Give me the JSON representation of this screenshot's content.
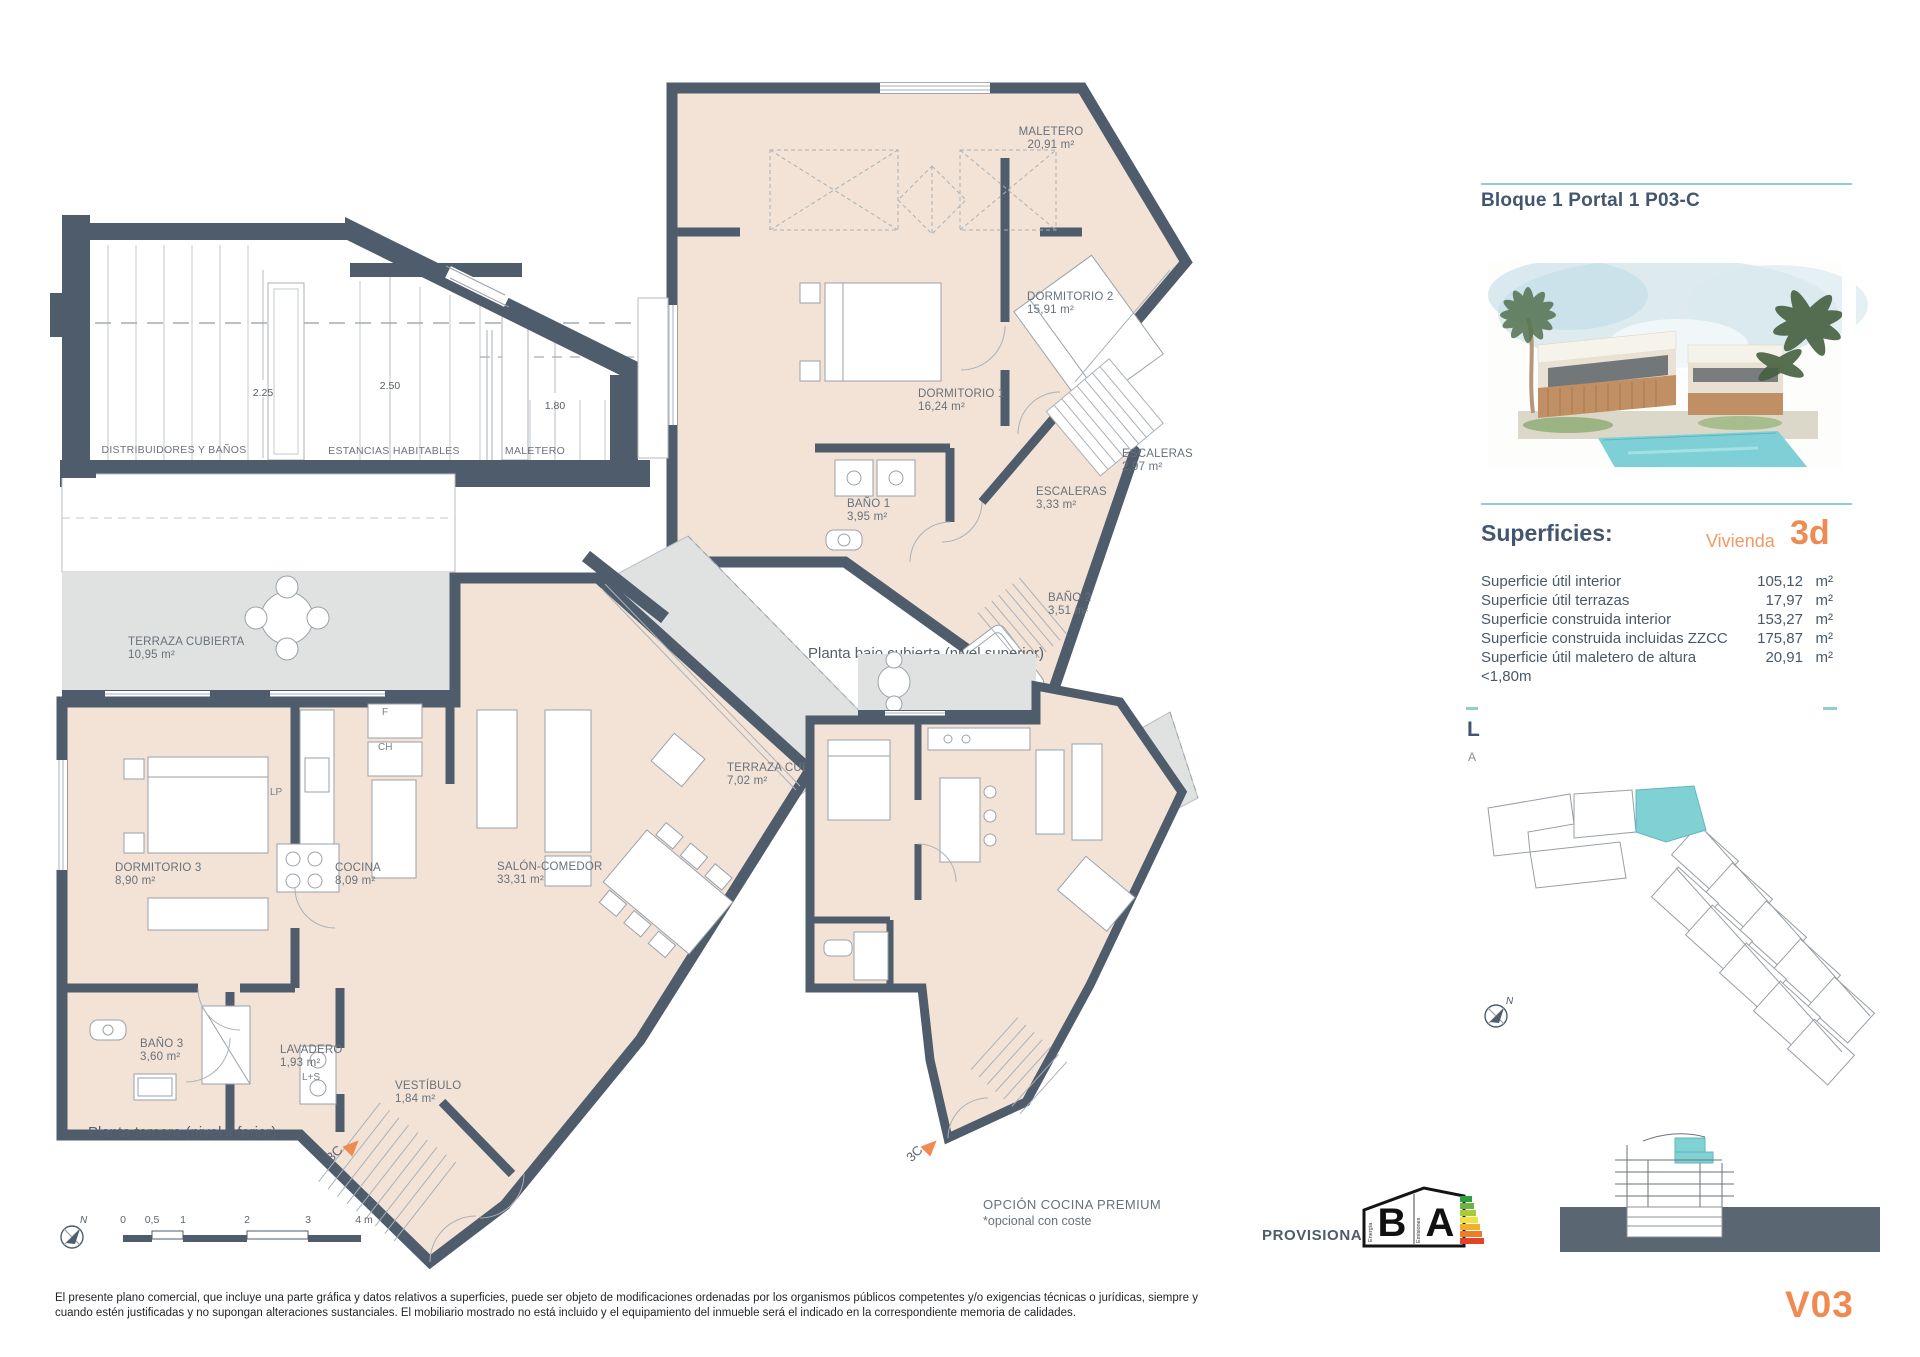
{
  "doc": {
    "version": "V03",
    "provisional": "PROVISIONAL",
    "disclaimer1": "El presente plano comercial, que incluye una parte gráfica y datos relativos a superficies, puede ser objeto de modificaciones ordenadas por los organismos públicos competentes y/o exigencias técnicas o jurídicas, siempre y",
    "disclaimer2": "cuando estén justificadas y no supongan alteraciones sustanciales. El mobiliario mostrado no está incluido y el equipamiento del inmueble será el indicado en la correspondiente memoria de calidades."
  },
  "colors": {
    "teal": "#8ed0d1",
    "orange": "#ef8a50",
    "slate": "#4e5c6b",
    "room_fill": "#f2e3d6",
    "terrace_fill": "#e0e2e1",
    "highlight": "#7fd1d4"
  },
  "section": {
    "caption": "Esquema de sección en planta ático",
    "dims": [
      "2.25",
      "2.50",
      "1.80"
    ],
    "zones": [
      "DISTRIBUIDORES Y BAÑOS",
      "ESTANCIAS HABITABLES",
      "MALETERO"
    ]
  },
  "upper_plan": {
    "caption": "Planta bajo cubierta (nivel superior)",
    "rooms": [
      {
        "name": "MALETERO",
        "area": "20,91 m²"
      },
      {
        "name": "DORMITORIO 2",
        "area": "15,91 m²"
      },
      {
        "name": "DORMITORIO 1",
        "area": "16,24 m²"
      },
      {
        "name": "BAÑO 1",
        "area": "3,95 m²"
      },
      {
        "name": "ESCALERAS",
        "area": "3,33 m²"
      },
      {
        "name": "ESCALERAS",
        "area": "2,97 m²"
      },
      {
        "name": "BAÑO 2",
        "area": "3,51 m²"
      }
    ]
  },
  "lower_plan": {
    "caption": "Planta tercera (nivel inferior)",
    "unit_marker": "3C",
    "rooms": [
      {
        "name": "TERRAZA CUBIERTA",
        "area": "10,95 m²"
      },
      {
        "name": "DORMITORIO 3",
        "area": "8,90 m²"
      },
      {
        "name": "COCINA",
        "area": "8,09 m²"
      },
      {
        "name": "SALÓN-COMEDOR",
        "area": "33,31 m²"
      },
      {
        "name": "TERRAZA CUBIERTA",
        "area": "7,02 m²"
      },
      {
        "name": "BAÑO 3",
        "area": "3,60 m²"
      },
      {
        "name": "LAVADERO",
        "area": "1,93 m²"
      },
      {
        "name": "VESTÍBULO",
        "area": "1,84 m²"
      }
    ],
    "appliances": {
      "f": "F",
      "ch": "CH",
      "lp": "LP",
      "ls": "L+S"
    }
  },
  "premium_plan": {
    "title": "OPCIÓN COCINA PREMIUM",
    "subtitle": "*opcional con coste",
    "unit_marker": "3C"
  },
  "right_panel": {
    "title": "Bloque 1 Portal 1 P03-C",
    "superficies_heading": "Superficies:",
    "vivienda_label": "Vivienda",
    "vivienda_code": "3d",
    "rows": [
      {
        "label": "Superficie útil interior",
        "value": "105,12",
        "unit": "m²"
      },
      {
        "label": "Superficie útil terrazas",
        "value": "17,97",
        "unit": "m²"
      },
      {
        "label": "Superficie construida interior",
        "value": "153,27",
        "unit": "m²"
      },
      {
        "label": "Superficie construida incluidas ZZCC",
        "value": "175,87",
        "unit": "m²"
      },
      {
        "label": "Superficie útil maletero de altura <1,80m",
        "value": "20,91",
        "unit": "m²"
      }
    ],
    "cropped_line1": "L",
    "cropped_line2": "A",
    "north_label": "N"
  },
  "scale_bar": {
    "ticks": [
      "0",
      "0,5",
      "1",
      "2",
      "3",
      "4 m"
    ],
    "north_label": "N"
  },
  "energy": {
    "letter_left": "B",
    "letter_right": "A",
    "axis_left": "Energía",
    "axis_right": "Emisiones"
  }
}
